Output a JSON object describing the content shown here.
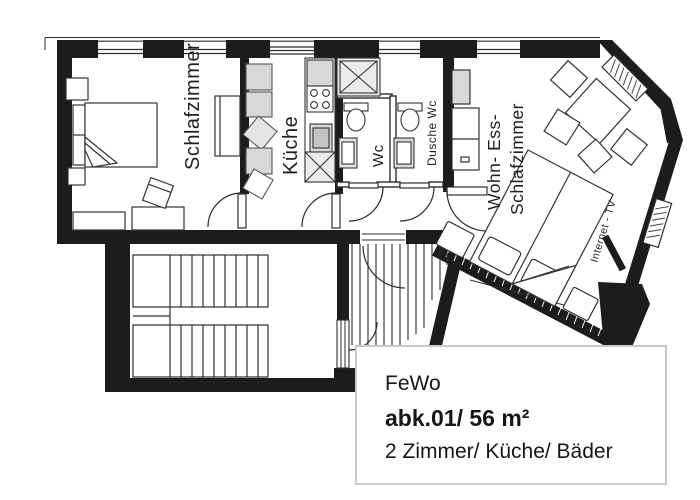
{
  "title_box": {
    "line1": "FeWo",
    "line2": "abk.01/ 56 m²",
    "line3": "2 Zimmer/ Küche/ Bäder"
  },
  "room_labels": {
    "bedroom": "Schlafzimmer",
    "kitchen": "Küche",
    "wc": "Wc",
    "shower_wc": "Dusche Wc",
    "living_line1": "Wohn- Ess-",
    "living_line2": "Schlafzimmer",
    "internet_tv": "Internet - TV"
  },
  "colors": {
    "wall": "#1c1c1c",
    "line": "#2e2e2e",
    "furniture_gray": "#d8d8d8",
    "appliance_gray": "#ebebeb",
    "box_border": "#c9c9c9"
  }
}
